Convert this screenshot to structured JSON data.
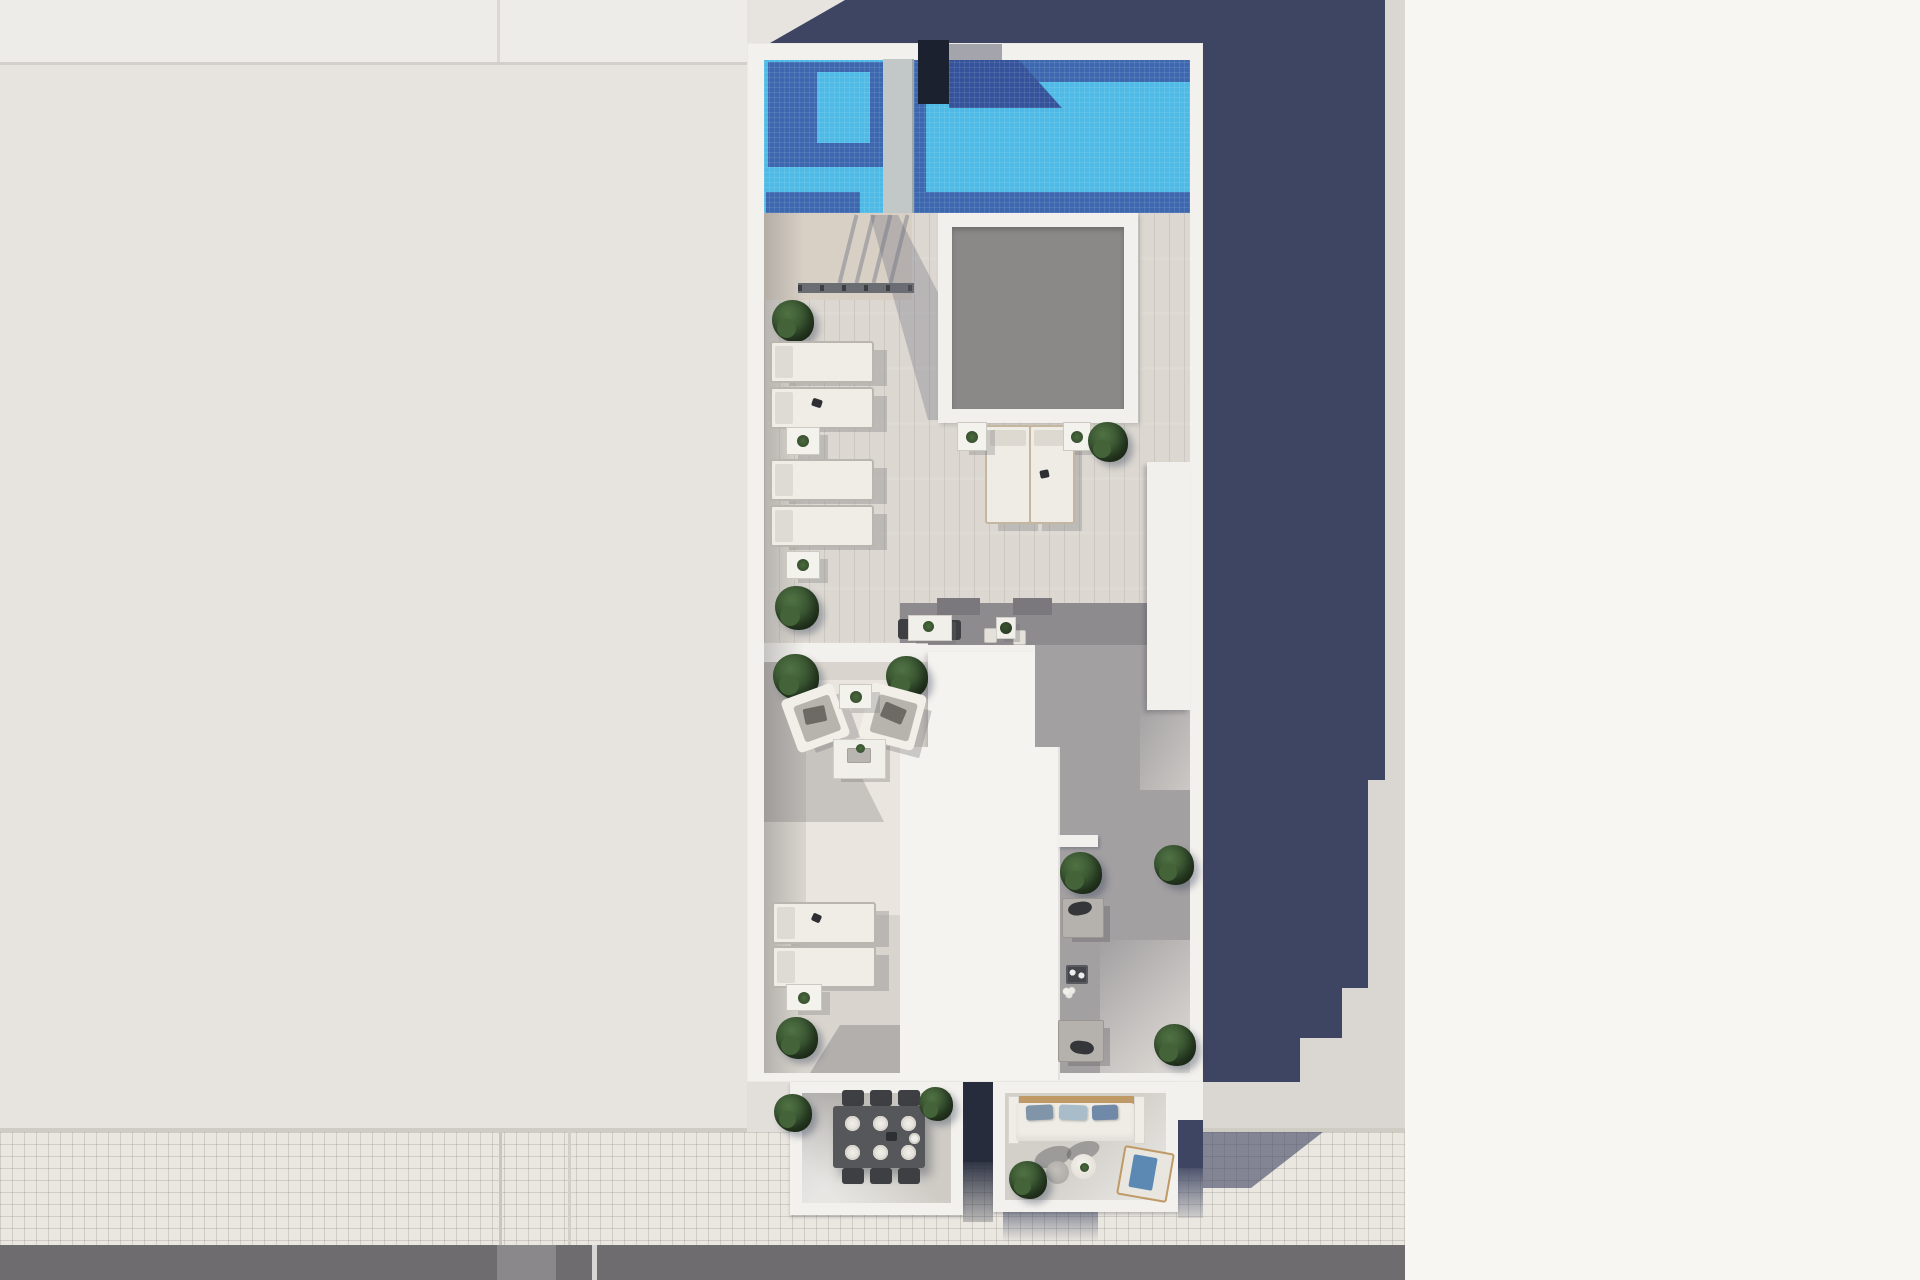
{
  "meta": {
    "title": "Aerial 3D render of a rooftop terrace floor plan with swimming pool",
    "width": 1920,
    "height": 1280
  },
  "colors": {
    "neighbor": "#e7e4e0",
    "neighborTop": "#eeece8",
    "strip": "#dad7d2",
    "whiteBright": "#f7f6f2",
    "navy": "#3e4563",
    "tile": "#eae7e0",
    "road": "#6f6c6f",
    "white": "#f3f1ed",
    "poolLight": "#4fbae6",
    "poolShadow": "#3d68b0",
    "poolDeep": "#35539a",
    "boxDark": "#1c2130",
    "plank": "#dcd8d1",
    "plankShade": "#a3a0a2",
    "wood": "#d8d0c5",
    "skyGrey": "#8b8987",
    "tan": "#c09a66"
  },
  "scene": {
    "regions": {
      "pool": "tiled swimming pool with submerged steps and shadowed water",
      "upper_terrace": "wood-deck sunbathing terrace with loungers and skylight",
      "lower_terrace": "lounge terrace with armchairs and coffee table",
      "corridor": "shaded walkway beside stair core with benches and planters",
      "balconies": "street-side dining balcony and sofa balcony",
      "street": "tiled sidewalk and asphalt road with lane markings"
    },
    "items": [
      {
        "c": "bush",
        "n": "bush-walkway",
        "x": 772,
        "y": 300,
        "w": 42,
        "h": 42
      },
      {
        "c": "lounger-h",
        "n": "sun-lounger",
        "x": 770,
        "y": 341,
        "w": 100,
        "h": 38
      },
      {
        "c": "lounger-h",
        "n": "sun-lounger",
        "x": 770,
        "y": 387,
        "w": 100,
        "h": 38
      },
      {
        "c": "dark-item",
        "n": "towel-item",
        "x": 812,
        "y": 399,
        "w": 10,
        "h": 8,
        "r": 18
      },
      {
        "c": "side-table",
        "n": "side-table-plant",
        "x": 786,
        "y": 427,
        "w": 32,
        "h": 26
      },
      {
        "c": "lounger-h",
        "n": "sun-lounger",
        "x": 770,
        "y": 459,
        "w": 100,
        "h": 38
      },
      {
        "c": "lounger-h",
        "n": "sun-lounger",
        "x": 770,
        "y": 505,
        "w": 100,
        "h": 38
      },
      {
        "c": "side-table",
        "n": "side-table-plant",
        "x": 786,
        "y": 551,
        "w": 32,
        "h": 26
      },
      {
        "c": "bush",
        "n": "bush-terrace",
        "x": 775,
        "y": 586,
        "w": 44,
        "h": 44
      },
      {
        "c": "lounger-v",
        "n": "sun-lounger",
        "x": 985,
        "y": 425,
        "w": 42,
        "h": 95
      },
      {
        "c": "lounger-v",
        "n": "sun-lounger",
        "x": 1029,
        "y": 425,
        "w": 42,
        "h": 95
      },
      {
        "c": "dark-item",
        "n": "towel-item",
        "x": 1040,
        "y": 470,
        "w": 9,
        "h": 8,
        "r": -12
      },
      {
        "c": "side-table",
        "n": "side-table-plant",
        "x": 957,
        "y": 422,
        "w": 28,
        "h": 27
      },
      {
        "c": "side-table",
        "n": "side-table-plant",
        "x": 1063,
        "y": 422,
        "w": 26,
        "h": 27
      },
      {
        "c": "bush",
        "n": "bush-skylight",
        "x": 1088,
        "y": 422,
        "w": 40,
        "h": 40
      },
      {
        "c": "chair-dark",
        "n": "bistro-chair",
        "x": 898,
        "y": 619,
        "w": 13,
        "h": 20
      },
      {
        "c": "chair-dark",
        "n": "bistro-chair",
        "x": 948,
        "y": 620,
        "w": 13,
        "h": 20
      },
      {
        "c": "table-white",
        "n": "bistro-table",
        "x": 908,
        "y": 615,
        "w": 42,
        "h": 24
      },
      {
        "c": "plant-dot",
        "n": "table-plant",
        "x": 923,
        "y": 621,
        "w": 11,
        "h": 11
      },
      {
        "c": "chair-light",
        "n": "bistro-chair",
        "x": 984,
        "y": 628,
        "w": 11,
        "h": 13
      },
      {
        "c": "chair-light",
        "n": "bistro-chair",
        "x": 1013,
        "y": 630,
        "w": 11,
        "h": 13
      },
      {
        "c": "table-white",
        "n": "bistro-table",
        "x": 996,
        "y": 617,
        "w": 18,
        "h": 20
      },
      {
        "c": "pot",
        "n": "plant-pot",
        "x": 1000,
        "y": 622,
        "w": 12,
        "h": 12
      },
      {
        "c": "bush",
        "n": "bush-lounge",
        "x": 773,
        "y": 654,
        "w": 46,
        "h": 46
      },
      {
        "c": "bush",
        "n": "bush-lounge",
        "x": 886,
        "y": 656,
        "w": 42,
        "h": 42
      },
      {
        "c": "armchair",
        "n": "armchair",
        "x": 788,
        "y": 690,
        "w": 55,
        "h": 56,
        "r": -20
      },
      {
        "c": "armchair",
        "n": "armchair",
        "x": 864,
        "y": 688,
        "w": 57,
        "h": 57,
        "r": 15
      },
      {
        "c": "side-table",
        "n": "side-table-plant",
        "x": 839,
        "y": 684,
        "w": 31,
        "h": 23
      },
      {
        "c": "table-white",
        "n": "coffee-table",
        "x": 833,
        "y": 739,
        "w": 51,
        "h": 38
      },
      {
        "c": "tray",
        "n": "tray",
        "x": 847,
        "y": 748,
        "w": 24,
        "h": 15
      },
      {
        "c": "plant-dot",
        "n": "table-plant",
        "x": 856,
        "y": 744,
        "w": 9,
        "h": 9
      },
      {
        "c": "lounger-h",
        "n": "sun-lounger",
        "x": 772,
        "y": 902,
        "w": 100,
        "h": 38
      },
      {
        "c": "lounger-h",
        "n": "sun-lounger",
        "x": 772,
        "y": 946,
        "w": 100,
        "h": 38
      },
      {
        "c": "dark-item",
        "n": "towel-item",
        "x": 812,
        "y": 914,
        "w": 9,
        "h": 8,
        "r": 25
      },
      {
        "c": "side-table",
        "n": "side-table-plant",
        "x": 786,
        "y": 984,
        "w": 34,
        "h": 25
      },
      {
        "c": "bush",
        "n": "bush-terrace",
        "x": 776,
        "y": 1017,
        "w": 42,
        "h": 42
      },
      {
        "c": "ledge-white",
        "n": "planter-ledge",
        "x": 1058,
        "y": 835,
        "w": 40,
        "h": 12
      },
      {
        "c": "bush",
        "n": "bush-corridor",
        "x": 1060,
        "y": 852,
        "w": 42,
        "h": 42
      },
      {
        "c": "bush",
        "n": "bush-corridor",
        "x": 1154,
        "y": 845,
        "w": 40,
        "h": 40
      },
      {
        "c": "bench",
        "n": "bench",
        "x": 1062,
        "y": 898,
        "w": 40,
        "h": 38
      },
      {
        "c": "pillow-dark",
        "n": "bench-pillow",
        "x": 1068,
        "y": 902,
        "w": 24,
        "h": 13,
        "r": -10
      },
      {
        "c": "tea-table",
        "n": "tea-table",
        "x": 1066,
        "y": 965,
        "w": 22,
        "h": 19
      },
      {
        "c": "tea-flowers",
        "n": "flowers",
        "x": 1060,
        "y": 985,
        "w": 18,
        "h": 14
      },
      {
        "c": "bench",
        "n": "bench",
        "x": 1058,
        "y": 1020,
        "w": 44,
        "h": 40
      },
      {
        "c": "pillow-dark",
        "n": "bench-pillow",
        "x": 1070,
        "y": 1041,
        "w": 24,
        "h": 13,
        "r": 8
      },
      {
        "c": "bush",
        "n": "bush-corridor",
        "x": 1154,
        "y": 1024,
        "w": 42,
        "h": 42
      },
      {
        "c": "bush",
        "n": "bush-balcony",
        "x": 774,
        "y": 1094,
        "w": 38,
        "h": 38
      },
      {
        "c": "chair-dark",
        "n": "dining-chair",
        "x": 842,
        "y": 1090,
        "w": 22,
        "h": 16
      },
      {
        "c": "chair-dark",
        "n": "dining-chair",
        "x": 870,
        "y": 1090,
        "w": 22,
        "h": 16
      },
      {
        "c": "chair-dark",
        "n": "dining-chair",
        "x": 898,
        "y": 1090,
        "w": 22,
        "h": 16
      },
      {
        "c": "dining-table",
        "n": "dining-table",
        "x": 833,
        "y": 1106,
        "w": 92,
        "h": 62
      },
      {
        "c": "plate",
        "n": "plate",
        "x": 845,
        "y": 1116,
        "w": 15,
        "h": 15
      },
      {
        "c": "plate",
        "n": "plate",
        "x": 873,
        "y": 1116,
        "w": 15,
        "h": 15
      },
      {
        "c": "plate",
        "n": "plate",
        "x": 901,
        "y": 1116,
        "w": 15,
        "h": 15
      },
      {
        "c": "plate",
        "n": "plate",
        "x": 845,
        "y": 1145,
        "w": 15,
        "h": 15
      },
      {
        "c": "plate",
        "n": "plate",
        "x": 873,
        "y": 1145,
        "w": 15,
        "h": 15
      },
      {
        "c": "plate",
        "n": "plate",
        "x": 901,
        "y": 1145,
        "w": 15,
        "h": 15
      },
      {
        "c": "teapot",
        "n": "teapot",
        "x": 909,
        "y": 1133,
        "w": 11,
        "h": 11
      },
      {
        "c": "dark-item",
        "n": "table-item",
        "x": 886,
        "y": 1132,
        "w": 11,
        "h": 9
      },
      {
        "c": "chair-dark",
        "n": "dining-chair",
        "x": 842,
        "y": 1168,
        "w": 22,
        "h": 16
      },
      {
        "c": "chair-dark",
        "n": "dining-chair",
        "x": 870,
        "y": 1168,
        "w": 22,
        "h": 16
      },
      {
        "c": "chair-dark",
        "n": "dining-chair",
        "x": 898,
        "y": 1168,
        "w": 22,
        "h": 16
      },
      {
        "c": "bush",
        "n": "bush-balcony",
        "x": 919,
        "y": 1087,
        "w": 34,
        "h": 34
      },
      {
        "c": "sofa-back",
        "n": "sofa-backrest",
        "x": 1016,
        "y": 1096,
        "w": 119,
        "h": 8
      },
      {
        "c": "sofa-arm",
        "n": "sofa-armrest",
        "x": 1008,
        "y": 1096,
        "w": 9,
        "h": 46
      },
      {
        "c": "sofa-arm",
        "n": "sofa-armrest",
        "x": 1134,
        "y": 1096,
        "w": 9,
        "h": 46
      },
      {
        "c": "sofa-seat",
        "n": "sofa-seat",
        "x": 1016,
        "y": 1103,
        "w": 118,
        "h": 38
      },
      {
        "c": "pillow",
        "n": "sofa-pillow",
        "x": 1026,
        "y": 1105,
        "w": 27,
        "h": 15,
        "bg": "#8095a8",
        "r": -3
      },
      {
        "c": "pillow",
        "n": "sofa-pillow",
        "x": 1059,
        "y": 1105,
        "w": 28,
        "h": 15,
        "bg": "#a9bcc9",
        "r": 2
      },
      {
        "c": "pillow",
        "n": "sofa-pillow",
        "x": 1092,
        "y": 1105,
        "w": 26,
        "h": 15,
        "bg": "#7189a9",
        "r": -2
      },
      {
        "c": "soft-shadow",
        "n": "pouf-shadow",
        "x": 1034,
        "y": 1147,
        "w": 38,
        "h": 20,
        "r": -18
      },
      {
        "c": "soft-shadow",
        "n": "pouf-shadow",
        "x": 1066,
        "y": 1142,
        "w": 34,
        "h": 18,
        "r": -18
      },
      {
        "c": "pouf-grey",
        "n": "pouf",
        "x": 1046,
        "y": 1161,
        "w": 23,
        "h": 23
      },
      {
        "c": "pouf-white",
        "n": "pouf-plant",
        "x": 1071,
        "y": 1154,
        "w": 25,
        "h": 25
      },
      {
        "c": "chaise-frame",
        "n": "chaise",
        "x": 1120,
        "y": 1149,
        "w": 47,
        "h": 46,
        "r": 10
      },
      {
        "c": "chaise-cushion",
        "n": "chaise-cushion",
        "x": 1131,
        "y": 1156,
        "w": 24,
        "h": 33,
        "r": 10
      },
      {
        "c": "bush",
        "n": "bush-balcony",
        "x": 1009,
        "y": 1161,
        "w": 38,
        "h": 38
      }
    ]
  }
}
